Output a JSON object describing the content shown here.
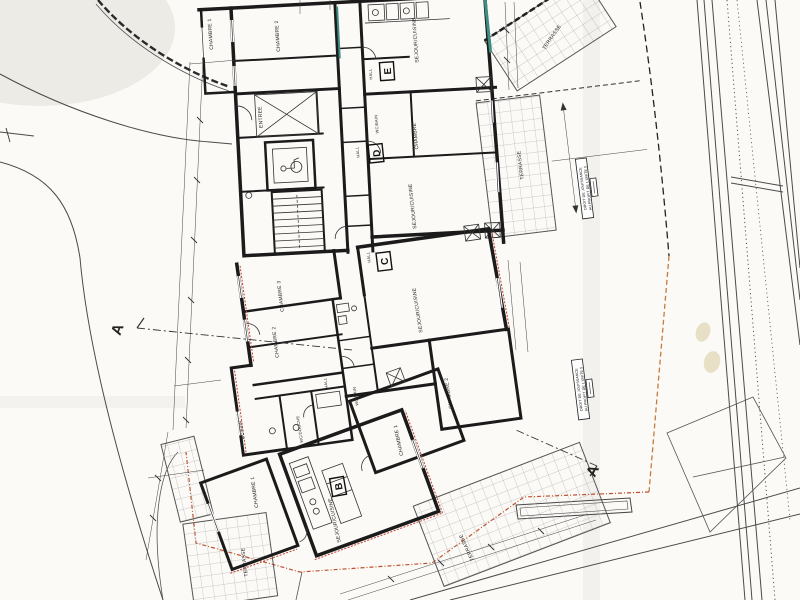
{
  "palette": {
    "wall": "#1b1b1b",
    "glazing_teal": "#3f8d80",
    "insulation_red": "#c63f2e",
    "boundary_orange": "#c97a3a",
    "paper": "#fbfaf7"
  },
  "labels": [
    {
      "text": "CHAMBRE 1"
    },
    {
      "text": "CHAMBRE 2"
    },
    {
      "text": "SEJOUR/CUISINE"
    },
    {
      "text": "HALL"
    },
    {
      "text": "ENTREE"
    },
    {
      "text": "WC/BAIN"
    },
    {
      "text": "CHAMBRE"
    },
    {
      "text": "HALL"
    },
    {
      "text": "SEJOUR/CUISINE"
    },
    {
      "text": "TERRASSE"
    },
    {
      "text": "TERRASSE"
    },
    {
      "text": "HALL"
    },
    {
      "text": "CHAMBRE 3"
    },
    {
      "text": "CHAMBRE 2"
    },
    {
      "text": "SEJOUR/CUISINE"
    },
    {
      "text": "HALL"
    },
    {
      "text": "WC/BAIN"
    },
    {
      "text": "WC/DOUCHE"
    },
    {
      "text": "WC/BAIN"
    },
    {
      "text": "CHAMBRE 2"
    },
    {
      "text": "CHAMBRE 1"
    },
    {
      "text": "CHAMBRE 1"
    },
    {
      "text": "SEJOUR/CUISINE"
    },
    {
      "text": "TERRASSE"
    },
    {
      "text": "TERRASSE"
    }
  ],
  "unit_letters": [
    {
      "text": "E"
    },
    {
      "text": "D"
    },
    {
      "text": "C"
    },
    {
      "text": "B"
    }
  ],
  "section_markers": [
    {
      "text": "A"
    },
    {
      "text": "A"
    }
  ],
  "easement": {
    "line1": "DROIT DE JOUISSANCE",
    "line2": "AU PROFIT DE L'UNITE 5"
  }
}
